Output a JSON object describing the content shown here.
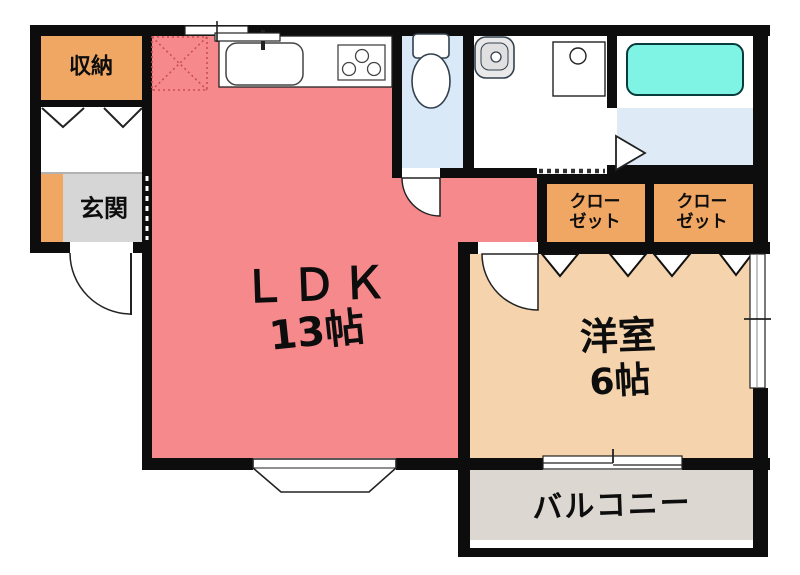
{
  "colors": {
    "wall": "#0d0d0d",
    "ldk_pink": "#F6898C",
    "closet_orange": "#F0A763",
    "room_beige": "#F5D3AC",
    "genkan_gray": "#D6D6D6",
    "balcony_gray": "#DCD7D1",
    "toilet_blue": "#D9E9F8",
    "bath_blue": "#DEEAF6",
    "tub_cyan": "#7FF4E5",
    "fridge_dotted_red": "#C94F52"
  },
  "rooms": {
    "storage": {
      "label": "収納"
    },
    "entrance": {
      "label": "玄関"
    },
    "ldk": {
      "name": "ＬＤＫ",
      "size": "13帖"
    },
    "western_room": {
      "name": "洋室",
      "size": "6帖"
    },
    "closet1": {
      "line1": "クロー",
      "line2": "ゼット"
    },
    "closet2": {
      "line1": "クロー",
      "line2": "ゼット"
    },
    "balcony": {
      "label": "バルコニー"
    }
  },
  "fixtures": {
    "kitchen": [
      "refrigerator-space-icon",
      "kitchen-sink-icon",
      "faucet-icon",
      "gas-stove-icon"
    ],
    "sanitary": [
      "toilet-icon",
      "wash-basin-icon",
      "washing-machine-icon",
      "bathtub-icon"
    ],
    "openings": [
      "hinged-door-icon",
      "folding-door-icon",
      "accordion-door-icon",
      "sliding-window-icon",
      "bay-window-icon",
      "balcony-window-icon"
    ]
  }
}
